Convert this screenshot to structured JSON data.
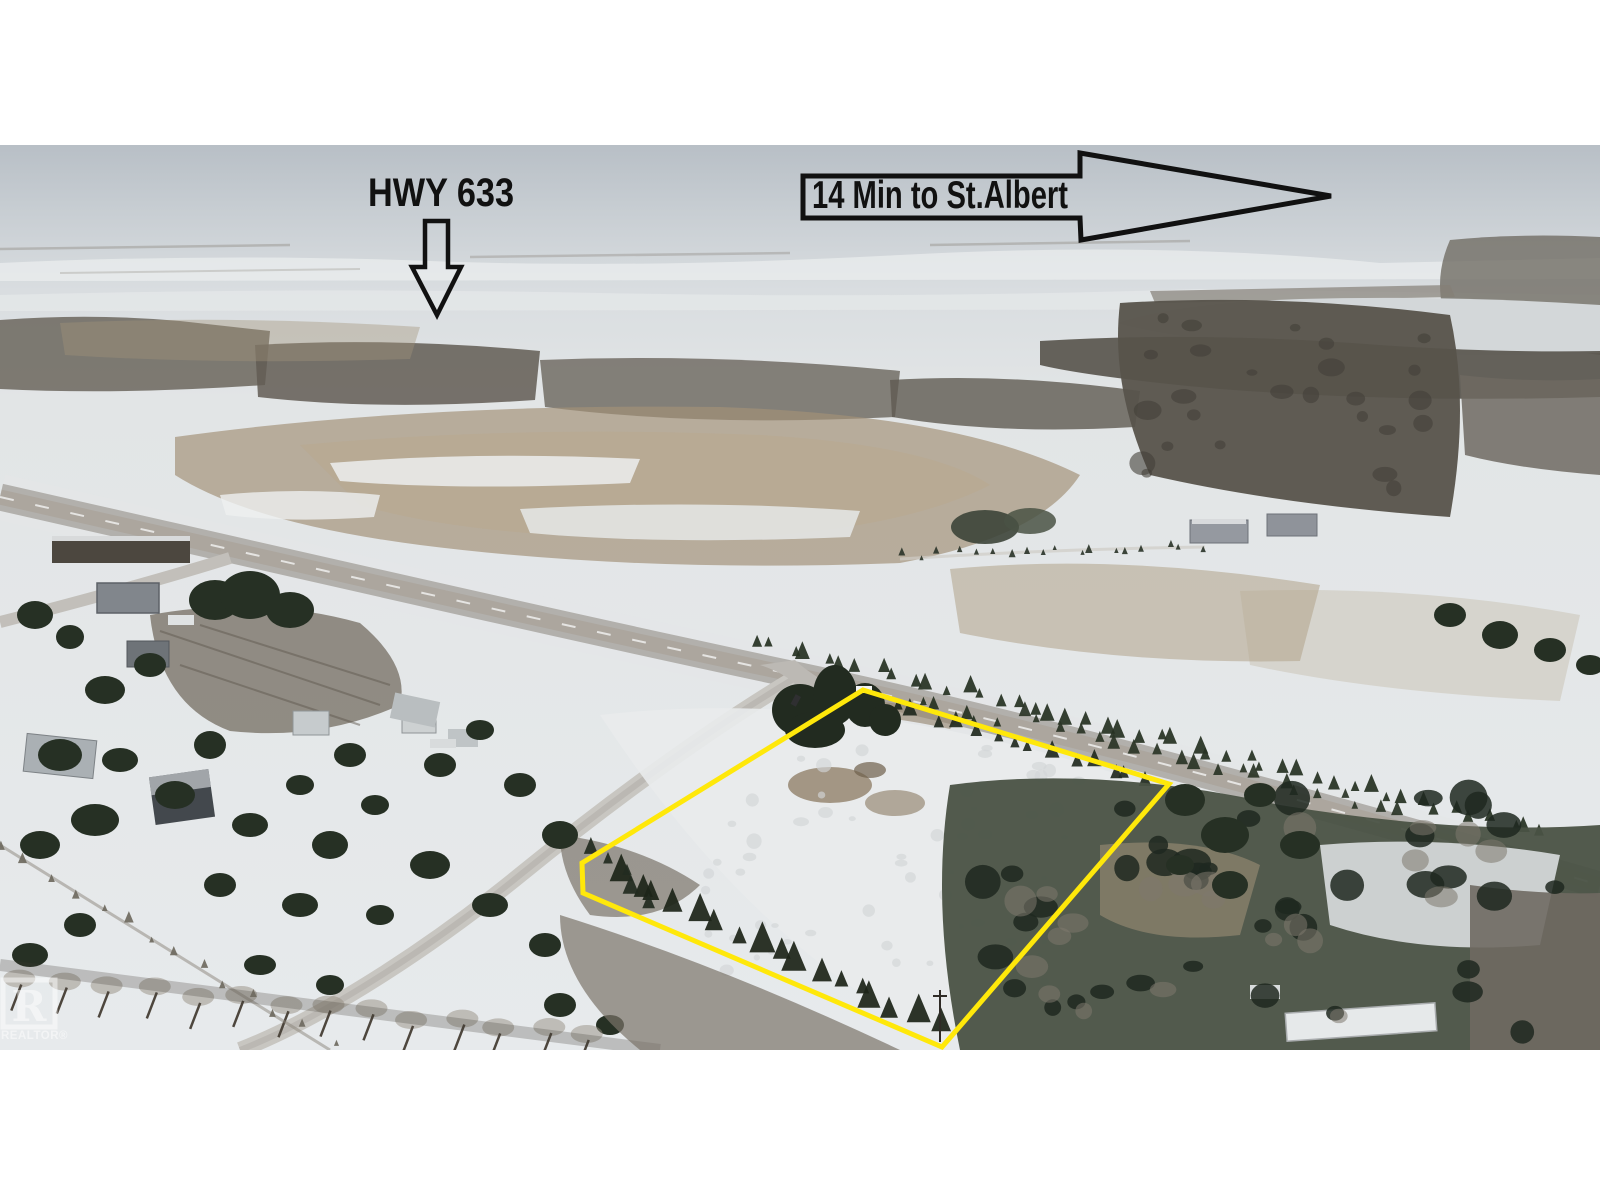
{
  "annotations": {
    "hwy_label": "HWY 633",
    "destination_label": "14 Min to St.Albert",
    "ink_color": "#111111"
  },
  "lot": {
    "outline_color": "#ffe80a",
    "polygon_points": "863,545 1169,639 942,902 583,748 582,718"
  },
  "watermark": {
    "letter": "R",
    "label": "REALTOR®"
  },
  "palette": {
    "page_bg": "#ffffff",
    "sky_top": "#b8bfc6",
    "sky_horizon": "#dfe3e5",
    "snow": "#e7eaec",
    "field_tan": "#a29078",
    "forest_dark": "#57534b",
    "evergreen": "#263024",
    "bare_trees": "#7a7469",
    "road_asphalt": "#b2b0ac",
    "local_road": "#c8c6c1",
    "lake": "#d3d7d9",
    "lot_color": "#ffe80a"
  }
}
